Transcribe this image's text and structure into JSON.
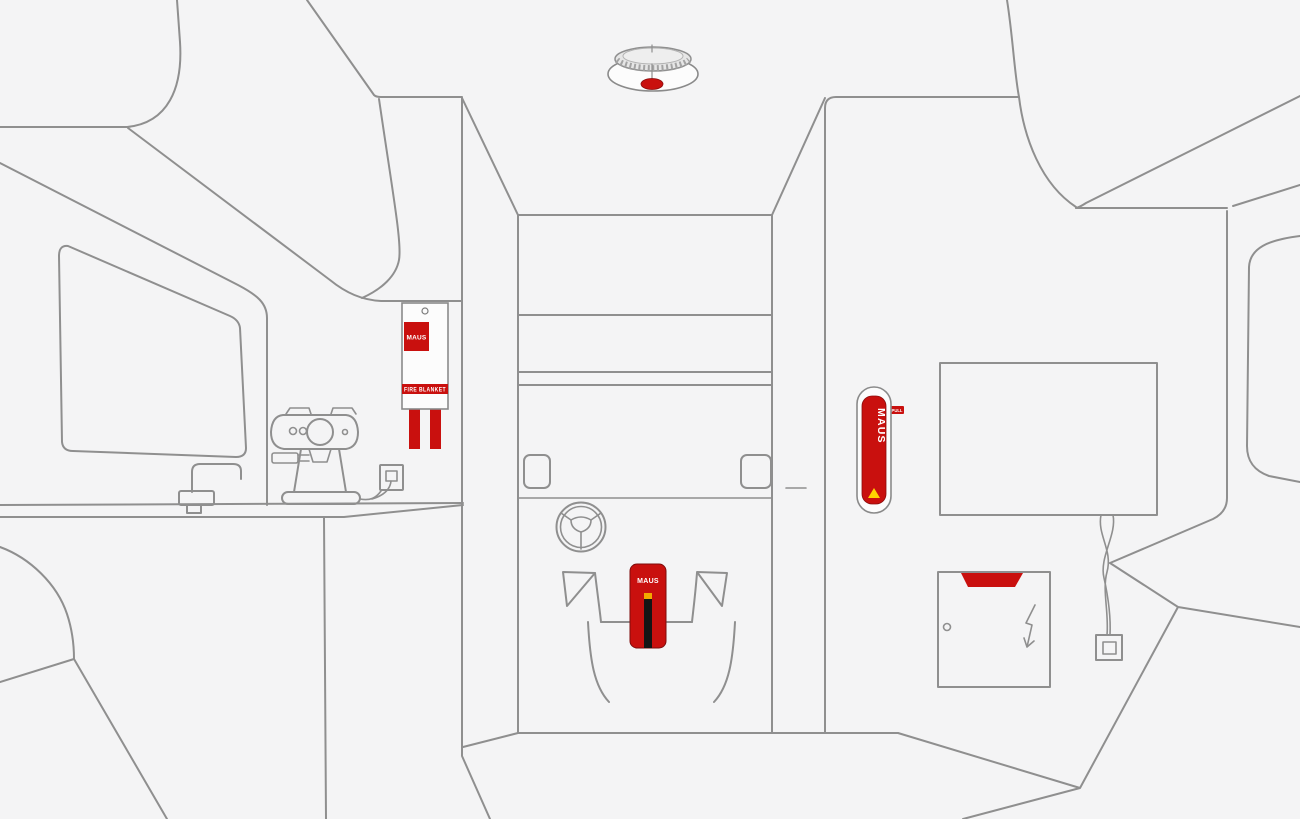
{
  "colors": {
    "background": "#f4f4f5",
    "line": "#8f8f8f",
    "brand_red": "#c9100e",
    "accent_yellow": "#ffd300",
    "cap_orange": "#f2a900",
    "stripe_black": "#151515"
  },
  "brand": {
    "name": "MAUS"
  },
  "products": {
    "fire_blanket": {
      "logo": "MAUS",
      "label": "FIRE BLANKET"
    },
    "wall_extinguisher": {
      "logo": "MAUS",
      "tab_label": "PULL"
    },
    "floor_extinguisher": {
      "logo": "MAUS"
    }
  },
  "scene": {
    "items": [
      "ceiling-smoke-alarm",
      "overhead-cabinets",
      "kitchen-window",
      "kitchen-counter",
      "faucet",
      "espresso-machine",
      "power-outlet",
      "fire-blanket",
      "cab-corridor",
      "driver-seat",
      "passenger-seat",
      "steering-wheel",
      "floor-extinguisher",
      "wall-extinguisher",
      "tv-screen",
      "electrical-cabinet",
      "power-plug",
      "wardrobe-panel",
      "bench"
    ]
  }
}
